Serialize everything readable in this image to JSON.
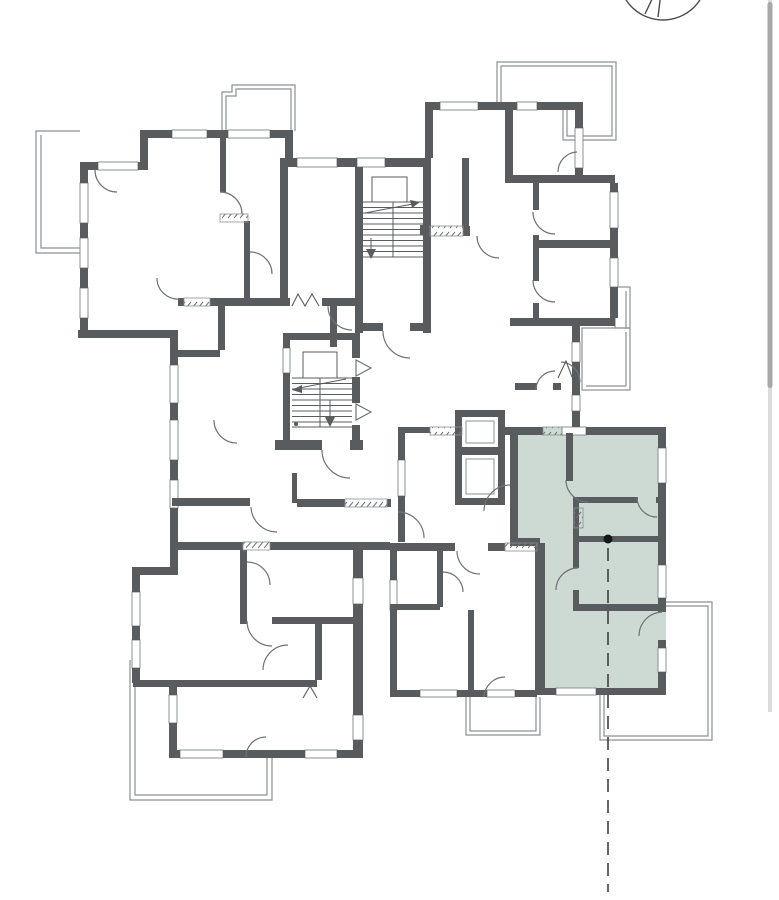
{
  "window": {
    "background": "#ffffff"
  },
  "colors": {
    "bg": "#ffffff",
    "wall": "#585c5f",
    "thin": "#8b9093",
    "door": "#6f7376",
    "hatch": "#6f7376",
    "highlight": "#cdd9d3",
    "marker": "#161616",
    "leader": "#3f3f3f",
    "compass": "#4c4c4c",
    "track": "#dcdcdc",
    "thumb": "#a8a8a8"
  },
  "floor_plan": {
    "highlighted_unit": {
      "fill": "#cdd9d3"
    },
    "marker": {
      "shape": "dot",
      "leader": "dashed-vertical-line"
    },
    "stairwells": 2,
    "elevator_shafts": 2,
    "compass_icon": "partial-circle-top-right"
  }
}
